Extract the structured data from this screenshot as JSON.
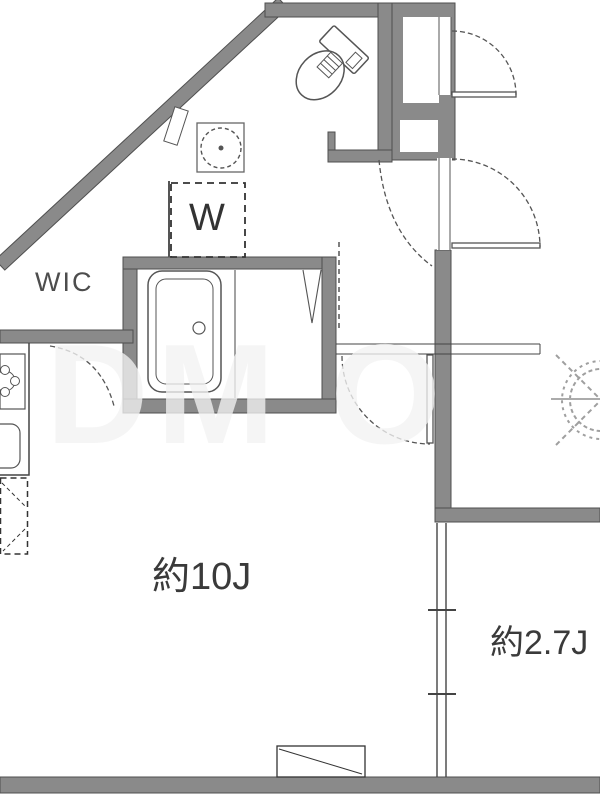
{
  "page": {
    "background": "#ffffff"
  },
  "rooms": {
    "wic_label": "WIC",
    "washer_label": "W",
    "main_room_label": "約10J",
    "service_room_label": "約2.7J"
  },
  "watermark": {
    "text": "DM O"
  },
  "colors": {
    "wall_fill": "#8a8a8a",
    "wall_outline": "#4f4f4f",
    "fixture_line": "#555555",
    "door_arc": "#555555",
    "label_text": "#3a3a3a"
  }
}
